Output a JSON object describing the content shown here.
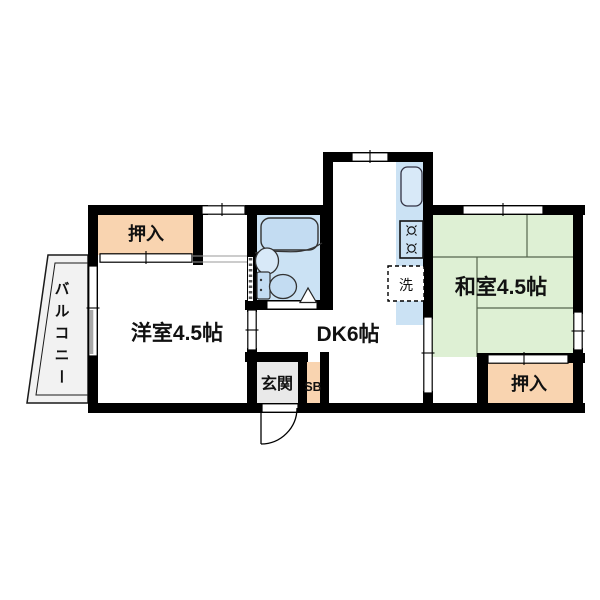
{
  "page": {
    "type": "apartment-floor-plan"
  },
  "labels": {
    "closet_top": "押入",
    "closet_bottom": "押入",
    "western_room": "洋室4.5帖",
    "japanese_room": "和室4.5帖",
    "dining_kitchen": "DK6帖",
    "entrance": "玄関",
    "shoe_box": "SB",
    "washing_machine": "洗",
    "balcony": "バルコニー"
  },
  "colors": {
    "wall": "#000000",
    "closet": "#F9D4B0",
    "tatami": "#DEF0D4",
    "water_area": "#CBE2F4",
    "fixture": "#C3DCF2",
    "basin": "#D8E9F8",
    "entrance_floor": "#E9E9E9",
    "balcony_floor": "#F2F2F2",
    "tatami_line": "#55654d",
    "line": "#1a1a1a"
  }
}
